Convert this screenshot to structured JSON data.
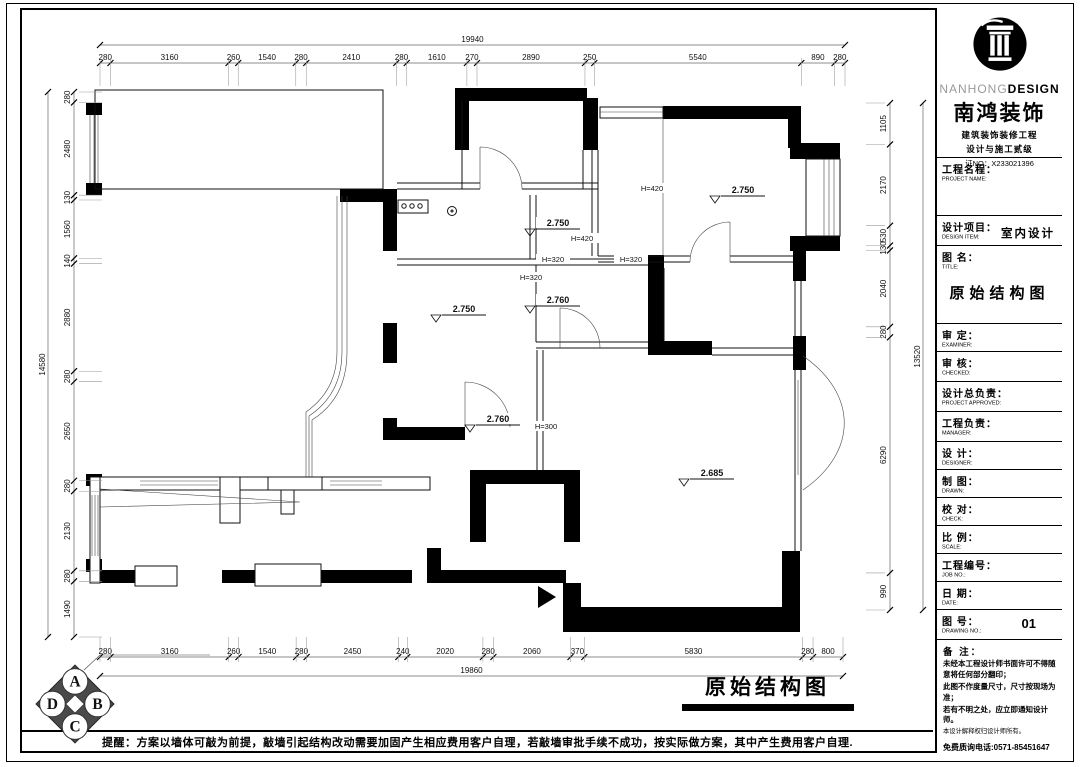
{
  "page": {
    "bottom_note": "提醒：方案以墙体可敲为前提，敲墙引起结构改动需要加固产生相应费用客户自理，若敲墙审批手续不成功，按实际做方案，其中产生费用客户自理.",
    "caption": "原始结构图",
    "corner_letters": [
      "A",
      "B",
      "C",
      "D"
    ]
  },
  "brand": {
    "en1": "NANHONG",
    "en2": "DESIGN",
    "cn": "南鸿装饰",
    "line1": "建筑装饰装修工程",
    "line2": "设计与施工贰级",
    "no": "证NO：X233021396"
  },
  "title_block": {
    "fields": [
      {
        "cn": "工程名程：",
        "en": "PROJECT NAME:",
        "value": "",
        "h": 58,
        "vc": ""
      },
      {
        "cn": "设计项目：",
        "en": "DESIGN ITEM:",
        "value": "室内设计",
        "h": 30,
        "vc": "vi"
      },
      {
        "cn": "图 名：",
        "en": "TITLE:",
        "value": "原始结构图",
        "h": 78,
        "vc": "vt"
      },
      {
        "cn": "审 定：",
        "en": "EXAMINER:",
        "value": "",
        "h": 28,
        "vc": ""
      },
      {
        "cn": "审 核：",
        "en": "CHECKED:",
        "value": "",
        "h": 30,
        "vc": ""
      },
      {
        "cn": "设计总负责：",
        "en": "PROJECT APPROVED:",
        "value": "",
        "h": 30,
        "vc": ""
      },
      {
        "cn": "工程负责：",
        "en": "MANAGER:",
        "value": "",
        "h": 30,
        "vc": ""
      },
      {
        "cn": "设 计：",
        "en": "DESIGNER:",
        "value": "",
        "h": 28,
        "vc": ""
      },
      {
        "cn": "制 图：",
        "en": "DRAWN:",
        "value": "",
        "h": 28,
        "vc": ""
      },
      {
        "cn": "校 对：",
        "en": "CHECK:",
        "value": "",
        "h": 28,
        "vc": ""
      },
      {
        "cn": "比 例：",
        "en": "SCALE:",
        "value": "",
        "h": 28,
        "vc": ""
      },
      {
        "cn": "工程编号：",
        "en": "JOB NO.:",
        "value": "",
        "h": 28,
        "vc": ""
      },
      {
        "cn": "日 期：",
        "en": "DATE:",
        "value": "",
        "h": 28,
        "vc": ""
      },
      {
        "cn": "图 号：",
        "en": "DRAWING NO.:",
        "value": "01",
        "h": 30,
        "vc": "vn"
      }
    ],
    "notes_title": "备 注：",
    "notes": [
      "未经本工程设计师书面许可不得随意将任何部分翻印；",
      "此图不作度量尺寸，尺寸按现场为准；",
      "若有不明之处，应立即通知设计师。",
      "本设计解释权归设计师所有。"
    ],
    "phone": "免费质询电话:0571-85451647"
  },
  "dimensions": {
    "top": {
      "values": [
        "280",
        "3160",
        "260",
        "1540",
        "280",
        "2410",
        "280",
        "1610",
        "270",
        "2890",
        "250",
        "5540",
        "890",
        "280"
      ],
      "total": "19940",
      "x0": 100,
      "x1": 845,
      "y": 63,
      "ty": 45,
      "e1": -5,
      "e2": 23
    },
    "bottom": {
      "values": [
        "280",
        "3160",
        "260",
        "1540",
        "280",
        "2450",
        "240",
        "2020",
        "280",
        "2060",
        "370",
        "5830",
        "280",
        "800"
      ],
      "total": "19860",
      "x0": 100,
      "x1": 843,
      "y": 657,
      "ty": 676,
      "e1": 5,
      "e2": -20
    },
    "left": {
      "values": [
        "280",
        "2480",
        "130",
        "1560",
        "140",
        "2880",
        "280",
        "2650",
        "280",
        "2130",
        "280",
        "1490"
      ],
      "total": "14580",
      "y0": 92,
      "y1": 637,
      "x": 74,
      "tx": 48,
      "e1": 5,
      "e2": 28
    },
    "right": {
      "values": [
        "1105",
        "2170",
        "530",
        "130",
        "2040",
        "280",
        "6290",
        "990"
      ],
      "total": "13520",
      "y0": 103,
      "y1": 610,
      "x": 890,
      "tx": 923,
      "e1": -5,
      "e2": -24
    }
  },
  "plan_labels": {
    "levels": [
      {
        "text": "2.750",
        "x": 556,
        "y": 226
      },
      {
        "text": "2.750",
        "x": 462,
        "y": 312
      },
      {
        "text": "2.760",
        "x": 556,
        "y": 303
      },
      {
        "text": "2.760",
        "x": 496,
        "y": 422
      },
      {
        "text": "2.685",
        "x": 710,
        "y": 476
      },
      {
        "text": "2.750",
        "x": 741,
        "y": 193
      }
    ],
    "heights": [
      {
        "text": "H=420",
        "x": 652,
        "y": 190
      },
      {
        "text": "H=420",
        "x": 582,
        "y": 240
      },
      {
        "text": "H=320",
        "x": 553,
        "y": 261
      },
      {
        "text": "H=320",
        "x": 631,
        "y": 261
      },
      {
        "text": "H=320",
        "x": 531,
        "y": 279
      },
      {
        "text": "H=300",
        "x": 546,
        "y": 428
      }
    ]
  }
}
